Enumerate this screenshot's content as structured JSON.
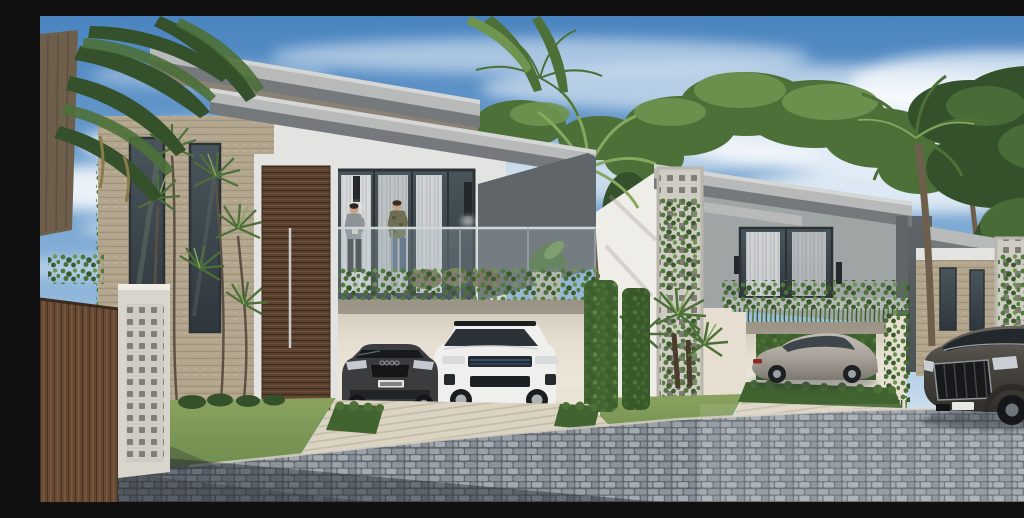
{
  "scene": {
    "title": "Architectural rendering: three modern flat-roof villas on a cobblestone street",
    "description": "Sunny 3D rendering of a row of modern two-storey villas. The nearest villa has a travertine wall, a tall wooden pivot door, a glass balcony with trailing vines where two men stand, and a carport with a dark sedan and a white SUV. A silver coupe sits on the middle villa's driveway and a dark SUV is parked on the cobblestone street to the right. Palm trees, hedges and lawns landscape the scene under a blue sky with wispy clouds.",
    "people": [
      {
        "label": "man-in-gray-shirt",
        "location": "villa-1 balcony"
      },
      {
        "label": "man-in-olive-jacket",
        "location": "villa-1 balcony"
      }
    ],
    "buildings": [
      {
        "label": "villa-1",
        "features": "cantilevered roof slabs, travertine stone wing, tall wood pivot door, vine-draped balcony, double carport"
      },
      {
        "label": "villa-2",
        "features": "perforated breeze-block corner with vines, vine balcony, hedge-lined carport"
      },
      {
        "label": "villa-3",
        "features": "partially hidden by palm and trees, perforated screen with vines"
      }
    ],
    "vehicles": [
      {
        "label": "dark-sedan",
        "location": "villa-1 carport"
      },
      {
        "label": "white-suv",
        "location": "villa-1 carport"
      },
      {
        "label": "silver-coupe",
        "location": "villa-2 driveway"
      },
      {
        "label": "dark-suv",
        "location": "street right"
      }
    ]
  },
  "palette": {
    "sky_top": "#4a84c0",
    "sky_mid": "#8ab3d8",
    "sky_low": "#c6dbec",
    "sky_horizon": "#dde9f2",
    "cloud": "#ffffff",
    "foliage_dark": "#35512c",
    "foliage_mid": "#4d7039",
    "foliage_light": "#6f9450",
    "palm_light": "#85a85e",
    "trunk": "#6e5f4c",
    "roof_light": "#d5d7d6",
    "roof_face": "#b7bab9",
    "roof_under": "#75797b",
    "wall_white": "#e3e4e2",
    "wall_bright": "#eeede8",
    "wall_gray": "#9fa4a4",
    "wall_dark": "#5f6568",
    "wall_shadow": "#8a8274",
    "stone": "#b3a68e",
    "screen": "#cfccc3",
    "screen_hole": "#7e7c74",
    "wood_door": "#5a4130",
    "wood_fence": "#6a4d38",
    "glass_top": "#49555c",
    "glass_bottom": "#2e373d",
    "curtain": "#e7e8e9",
    "garage": "#e6dfd1",
    "garage_dark": "#cfc7b6",
    "vine": "#4e7a3a",
    "vine_dark": "#39592a",
    "hedge": "#41632f",
    "grass": "#6d8c4e",
    "grass_light": "#8aa35f",
    "drive": "#dcd4c2",
    "drive_line": "#c6bda9",
    "cobble_gap": "#5f666d",
    "cobble_a": "#9aa1a8",
    "cobble_b": "#8b939b",
    "cobble_c": "#a3abb1",
    "cobble_d": "#848d95",
    "shadow": "#232830",
    "car_sedan": "#3a3c3e",
    "car_suv_white": "#eff0ee",
    "car_coupe": "#a8a29a",
    "car_q8": "#47443f",
    "skin": "#c9a184",
    "shirt_gray": "#8c9296",
    "jacket_olive": "#6d6e52",
    "jeans": "#5a7086",
    "sconce": "#25282a",
    "plate": "#e6e6e4"
  }
}
